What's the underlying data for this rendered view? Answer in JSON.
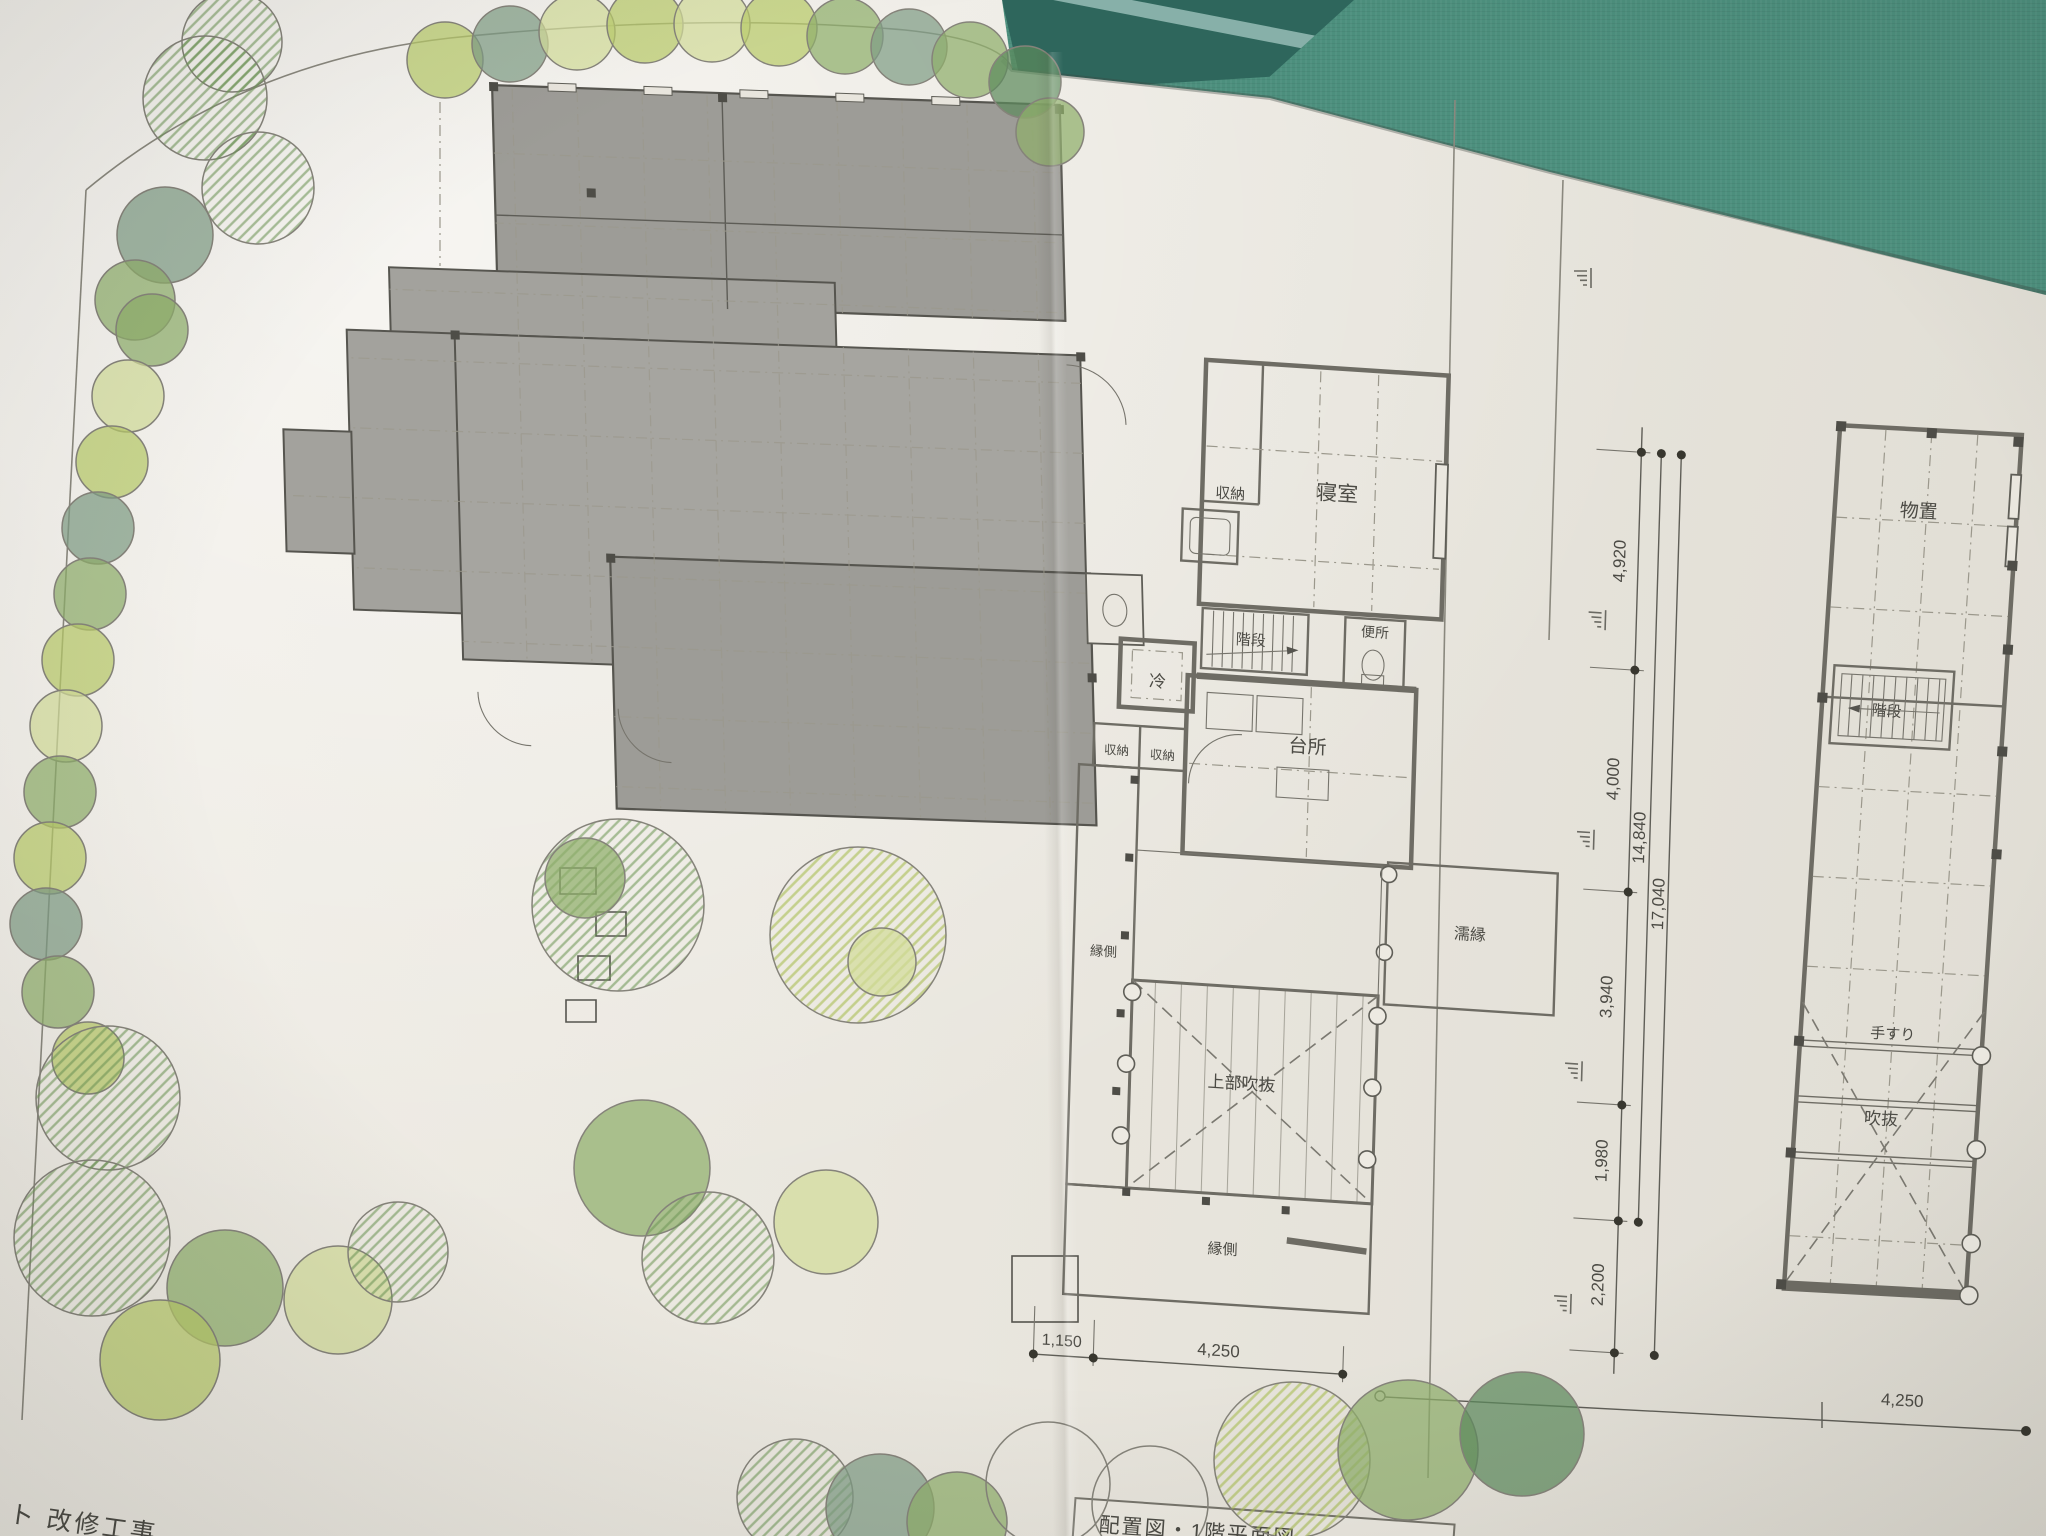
{
  "colors": {
    "fabric": "#4c8f7d",
    "fabric_dark": "#2e665c",
    "fabric_stripe": "#9dc3bd",
    "paper": "#eae7df",
    "roof_gray": "#a3a29d",
    "line": "#55544e",
    "tree_yellow_green": "#b9cb6a",
    "tree_green": "#8fae6b",
    "tree_blue_green": "#7f9c85",
    "tree_dark_green": "#5d8a5d",
    "pencil_hatch_green": "#6f9757"
  },
  "annotations": {
    "project_text": "ト 改修工事",
    "drawing_title": "配置図・1階平面図"
  },
  "floor_plan_1f": {
    "rooms": [
      {
        "id": "closet-north",
        "label": "収納"
      },
      {
        "id": "bedroom",
        "label": "寝室"
      },
      {
        "id": "stairs",
        "label": "階段"
      },
      {
        "id": "toilet",
        "label": "便所"
      },
      {
        "id": "refrigerator",
        "label": "冷"
      },
      {
        "id": "closet-west-1",
        "label": "収納"
      },
      {
        "id": "closet-west-2",
        "label": "収納"
      },
      {
        "id": "kitchen",
        "label": "台所"
      },
      {
        "id": "wet-veranda",
        "label": "濡縁"
      },
      {
        "id": "veranda-west",
        "label": "縁側"
      },
      {
        "id": "void-above",
        "label": "上部吹抜"
      },
      {
        "id": "veranda-south",
        "label": "縁側"
      }
    ],
    "dimensions": {
      "bottom": [
        "1,150",
        "4,250"
      ],
      "right_segments": [
        "4,920",
        "4,000",
        "3,940",
        "1,980",
        "2,200"
      ],
      "right_totals": [
        "14,840",
        "17,040"
      ]
    }
  },
  "floor_plan_2f": {
    "rooms": [
      {
        "id": "storeroom",
        "label": "物置"
      },
      {
        "id": "stairs",
        "label": "階段"
      },
      {
        "id": "handrail",
        "label": "手すり"
      },
      {
        "id": "void",
        "label": "吹抜"
      }
    ],
    "dimensions": {
      "bottom": "4,250"
    }
  }
}
